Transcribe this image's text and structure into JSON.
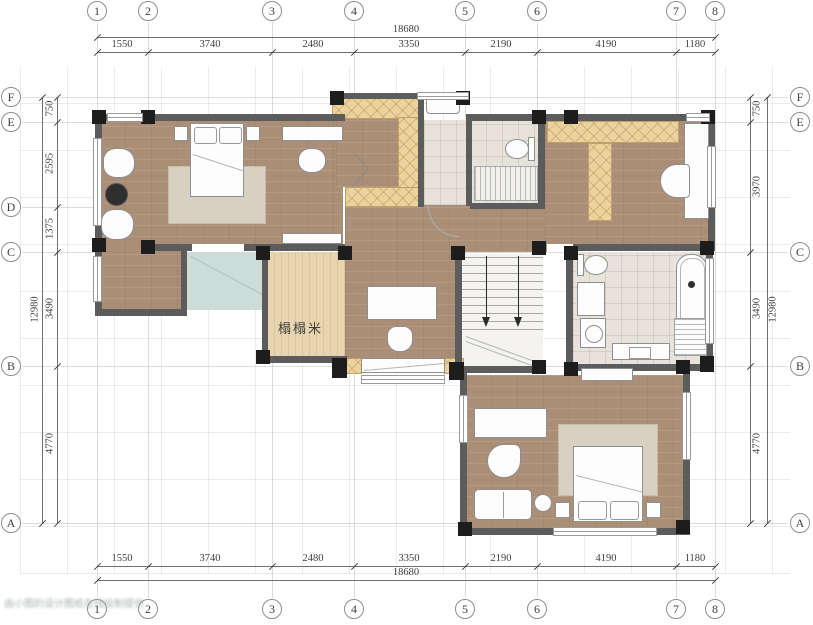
{
  "grid": {
    "top": [
      "1",
      "2",
      "3",
      "4",
      "5",
      "6",
      "7",
      "8"
    ],
    "bottom": [
      "1",
      "2",
      "3",
      "4",
      "5",
      "6",
      "7",
      "8"
    ],
    "left": [
      "F",
      "E",
      "D",
      "C",
      "B",
      "A"
    ],
    "right": [
      "F",
      "E",
      "C",
      "B",
      "A"
    ]
  },
  "dimensions": {
    "top": {
      "overall": "18680",
      "segments": [
        "1550",
        "3740",
        "2480",
        "3350",
        "2190",
        "4190",
        "1180"
      ]
    },
    "bottom": {
      "overall": "18680",
      "segments": [
        "1550",
        "3740",
        "2480",
        "3350",
        "2190",
        "4190",
        "1180"
      ]
    },
    "left": {
      "overall": "12980",
      "segments": [
        "750",
        "2595",
        "1375",
        "3490",
        "4770"
      ]
    },
    "right": {
      "overall": "12980",
      "segments": [
        "750",
        "3970",
        "3490",
        "4770"
      ]
    }
  },
  "rooms": {
    "tatami_label": "榻榻米"
  },
  "watermark": "由小图的设计图纸在线绘制提供",
  "colors": {
    "wood": "#ab8e76",
    "wood_light": "#e8d5b0",
    "cabinet": "#ecd29b",
    "tile": "#e7e3da",
    "glass": "#ccdcd8",
    "wall": "#5c5c5c",
    "column": "#1d1d1d"
  }
}
